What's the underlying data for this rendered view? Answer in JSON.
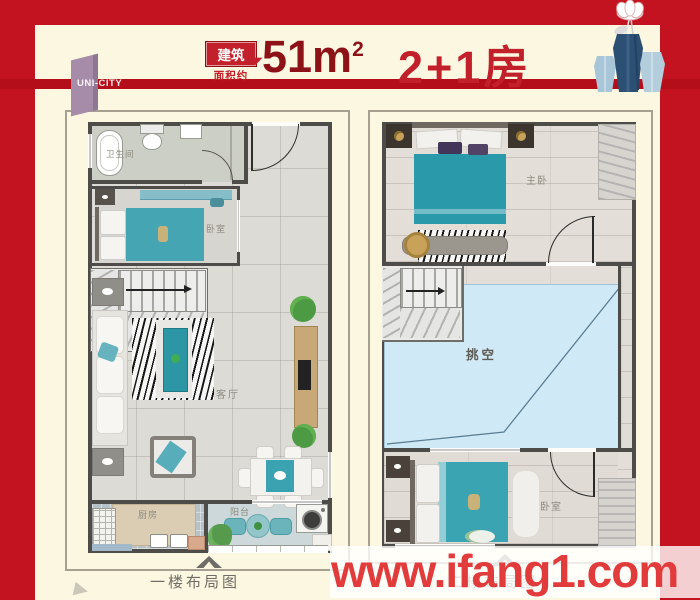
{
  "header": {
    "brand": "UNI-CITY",
    "badge_line1": "建筑",
    "badge_line2": "面积约",
    "area": "51m",
    "area_sup": "2",
    "unit": "2+1房"
  },
  "plan1": {
    "caption": "一楼布局图",
    "rooms": {
      "bathroom": "卫生间",
      "bedroom": "卧室",
      "living": "客厅",
      "kitchen": "厨房",
      "balcony": "阳台"
    }
  },
  "plan2": {
    "caption": "二楼布局图",
    "rooms": {
      "master": "主卧",
      "void": "挑空",
      "bedroom": "卧室"
    }
  },
  "watermark": {
    "text": "www.ifang1.com"
  },
  "colors": {
    "background_red": "#c41320",
    "stripe_red": "#b30e1a",
    "cream": "#fcf7e0",
    "maroon_text": "#8c1218",
    "red_text": "#c2202a",
    "accent_teal": "#2f9fae",
    "void_blue": "#cfe9f6",
    "watermark_red": "#e23b3b",
    "logo_mauve": "#a78ca9"
  }
}
